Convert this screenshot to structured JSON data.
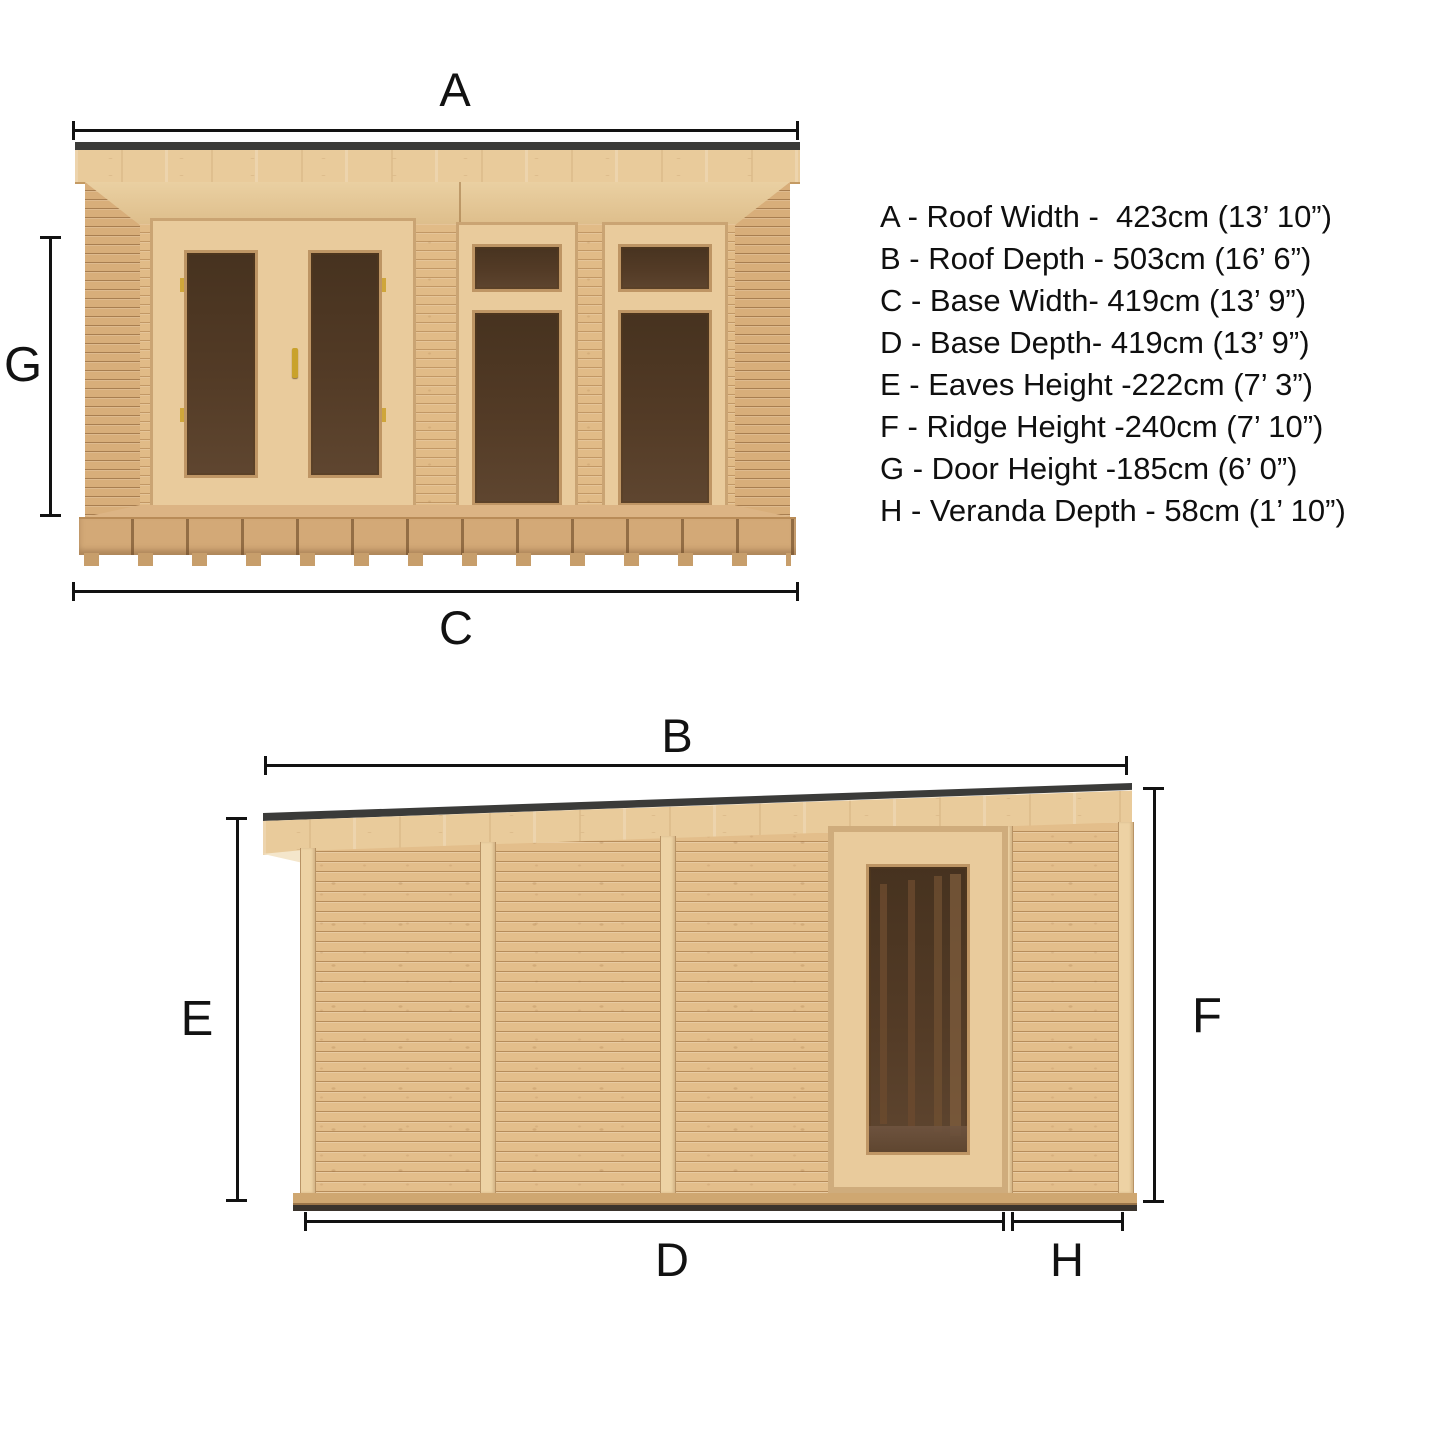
{
  "diagram": {
    "title": "Garden room dimension diagram",
    "front_view": {
      "dims": {
        "a": "A",
        "g": "G",
        "c": "C"
      }
    },
    "side_view": {
      "dims": {
        "b": "B",
        "e": "E",
        "f": "F",
        "d": "D",
        "h": "H"
      }
    },
    "legend": {
      "items": [
        {
          "text": "A - Roof Width -  423cm (13’ 10”)"
        },
        {
          "text": "B - Roof Depth - 503cm (16’ 6”)"
        },
        {
          "text": "C - Base Width- 419cm (13’ 9”)"
        },
        {
          "text": "D - Base Depth- 419cm (13’ 9”)"
        },
        {
          "text": "E - Eaves Height -222cm (7’ 3”)"
        },
        {
          "text": "F - Ridge Height -240cm (7’ 10”)"
        },
        {
          "text": "G - Door Height -185cm (6’ 0”)"
        },
        {
          "text": "H - Veranda Depth - 58cm (1’ 10”)"
        }
      ]
    },
    "colors": {
      "background": "#ffffff",
      "dimension_lines": "#121212",
      "roof_trim": "#3b3b39",
      "wood_light": "#e9cb9b",
      "wood_mid": "#e3be8b",
      "wood_deep": "#d8ae7a",
      "glass": "#4f3a26",
      "deck": "#d3a977",
      "handle_gold": "#c9a22c"
    }
  }
}
